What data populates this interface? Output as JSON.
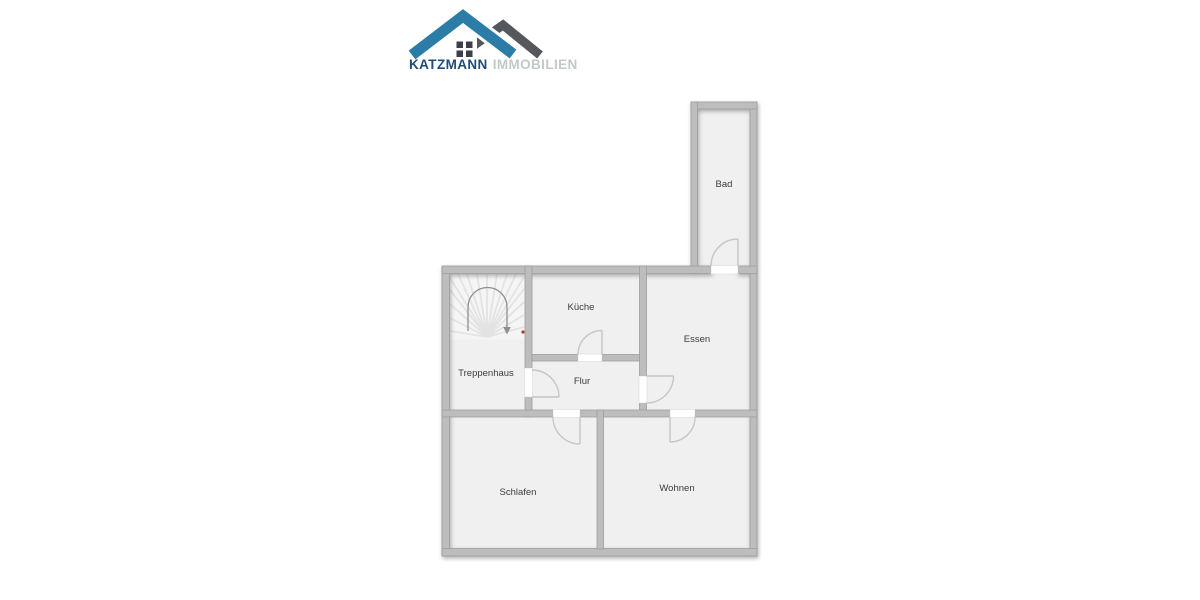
{
  "logo": {
    "name": "KATZMANN",
    "suffix": "IMMOBILIEN",
    "colors": {
      "roof_primary": "#2b7da7",
      "roof_secondary": "#54575c",
      "name": "#1d4d78",
      "suffix": "#c5c8cb",
      "window": "#3b4046"
    }
  },
  "floorplan": {
    "type": "floor-plan",
    "rooms": [
      {
        "id": "bad",
        "label": "Bad"
      },
      {
        "id": "kueche",
        "label": "Küche"
      },
      {
        "id": "essen",
        "label": "Essen"
      },
      {
        "id": "treppenhaus",
        "label": "Treppenhaus"
      },
      {
        "id": "flur",
        "label": "Flur"
      },
      {
        "id": "schlafen",
        "label": "Schlafen"
      },
      {
        "id": "wohnen",
        "label": "Wohnen"
      }
    ],
    "colors": {
      "wall": "#bdbdbd",
      "wall_edge": "#9e9e9e",
      "floor": "#f0f0f0",
      "door_swing": "#c6c6c6",
      "stair_tread": "#e3e3e3",
      "stair_arrow": "#8f8f8f",
      "marker_dot": "#b23434",
      "label_text": "#3c3c3c"
    }
  }
}
